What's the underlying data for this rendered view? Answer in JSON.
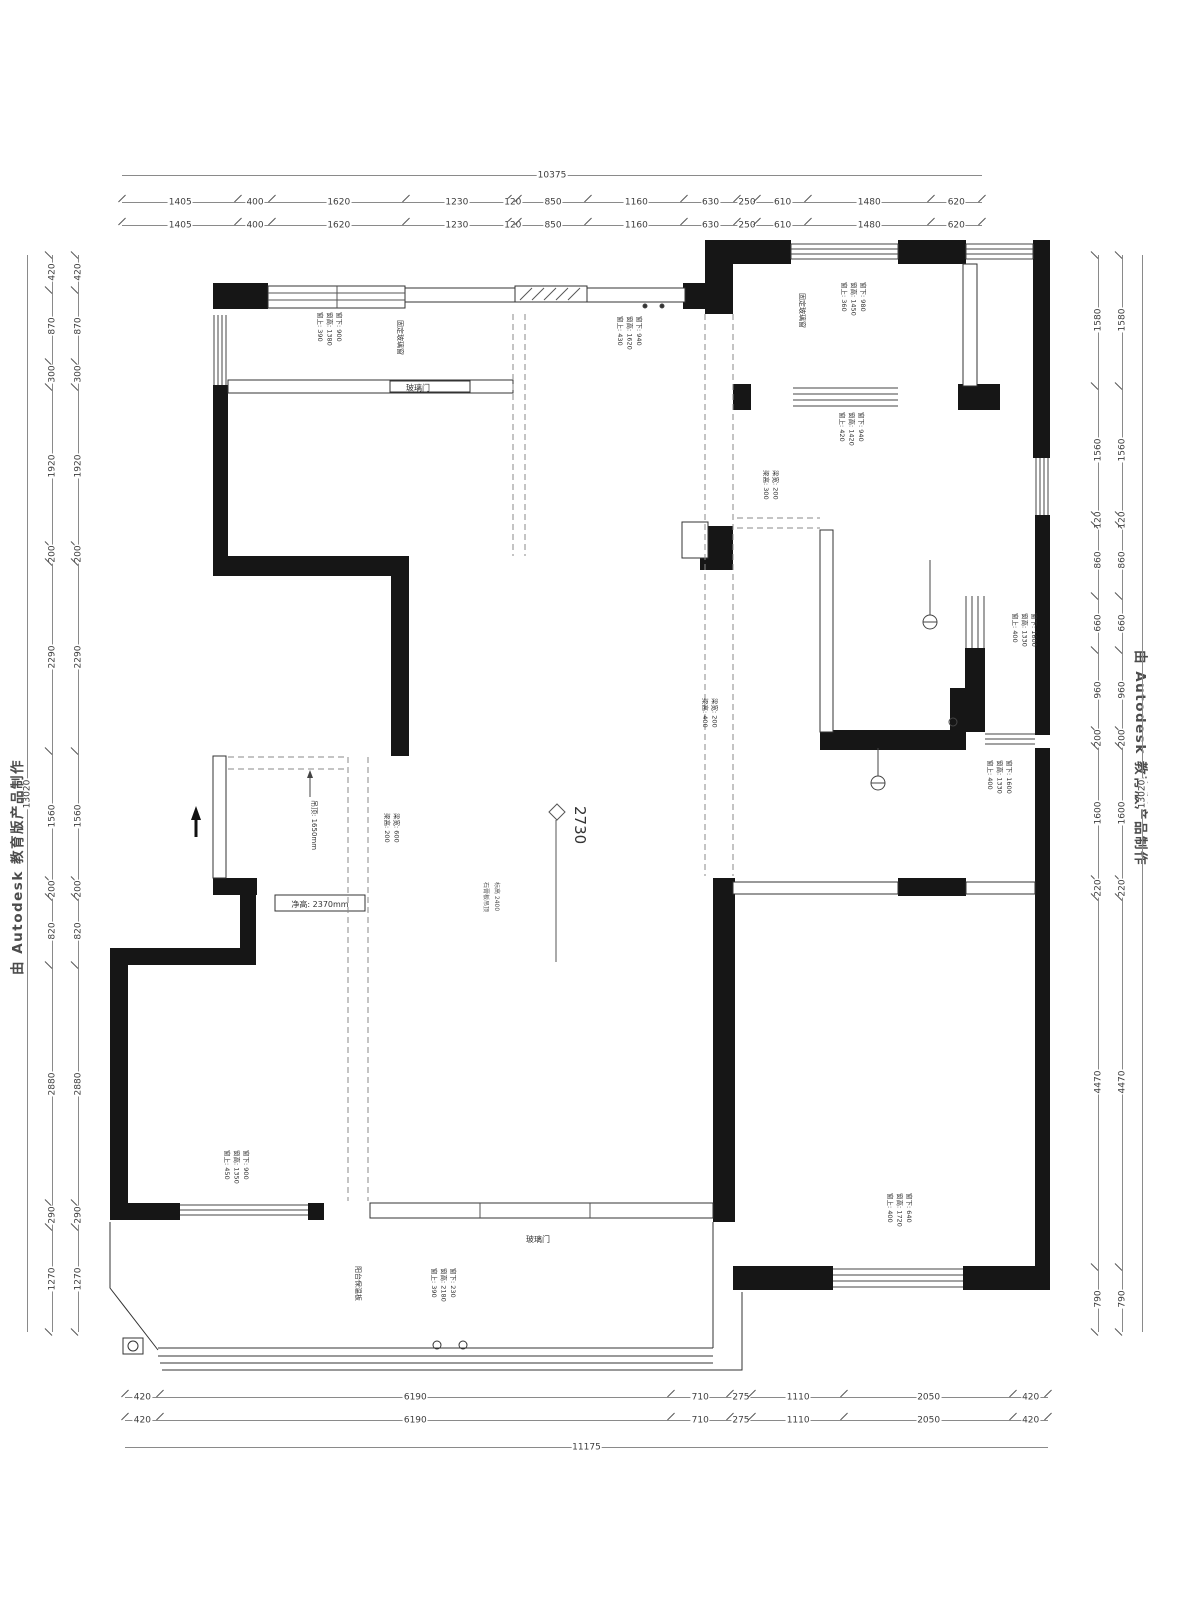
{
  "watermarks": {
    "left": "由 Autodesk 教育版产品制作",
    "right": "由 Autodesk 教育版产品制作"
  },
  "dimensions": {
    "top": {
      "total": "10375",
      "segments": [
        "1405",
        "400",
        "1620",
        "1230",
        "120",
        "850",
        "1160",
        "630",
        "250",
        "610",
        "1480",
        "620"
      ]
    },
    "bottom": {
      "total": "11175",
      "segments": [
        "420",
        "6190",
        "710",
        "275",
        "1110",
        "2050",
        "420"
      ]
    },
    "left": {
      "total": "13020",
      "segments": [
        "420",
        "870",
        "300",
        "1920",
        "200",
        "2290",
        "1560",
        "200",
        "820",
        "2880",
        "290",
        "1270"
      ]
    },
    "right": {
      "total": "13020",
      "segments": [
        "1580",
        "1560",
        "120",
        "860",
        "660",
        "960",
        "200",
        "1600",
        "220",
        "4470",
        "790"
      ]
    }
  },
  "plan_labels": {
    "ceiling_marker": "2730",
    "glass_door_top": "玻璃门",
    "glass_door_bottom": "玻璃门",
    "clear_height_box": "净高: 2370mm",
    "ceiling_note": "吊顶: 1650mm",
    "fixed_glass_left": "固定玻璃窗",
    "fixed_glass_right": "固定玻璃窗",
    "balcony_note": "阳台保温板",
    "ceiling_detail_1": "石膏板吊顶",
    "ceiling_detail_2": "标高 2400"
  },
  "window_annotations": {
    "a1": [
      "窗上: 390",
      "窗高: 1380",
      "窗下: 900"
    ],
    "a2": [
      "窗上: 430",
      "窗高: 1620",
      "窗下: 940"
    ],
    "a3": [
      "窗上: 360",
      "窗高: 1450",
      "窗下: 980"
    ],
    "a4": [
      "窗上: 420",
      "窗高: 1420",
      "窗下: 940"
    ],
    "a5": [
      "梁高: 300",
      "梁宽: 200"
    ],
    "a6": [
      "窗上: 400",
      "窗高: 1330",
      "窗下: 1600"
    ],
    "a7": [
      "梁高: 400",
      "梁宽: 200"
    ],
    "a8": [
      "窗上: 400",
      "窗高: 1330",
      "窗下: 1600"
    ],
    "a9": [
      "窗上: 450",
      "窗高: 1350",
      "窗下: 900"
    ],
    "a10": [
      "窗上: 400",
      "窗高: 1720",
      "窗下: 640"
    ],
    "a11": [
      "窗上: 390",
      "窗高: 2180",
      "窗下: 230"
    ],
    "a12b": [
      "梁高: 200",
      "梁宽: 600"
    ]
  },
  "colors": {
    "wall": "#161616",
    "thin_line": "#333333",
    "dim_line": "#8a8a8a",
    "text": "#3d3d3d"
  }
}
